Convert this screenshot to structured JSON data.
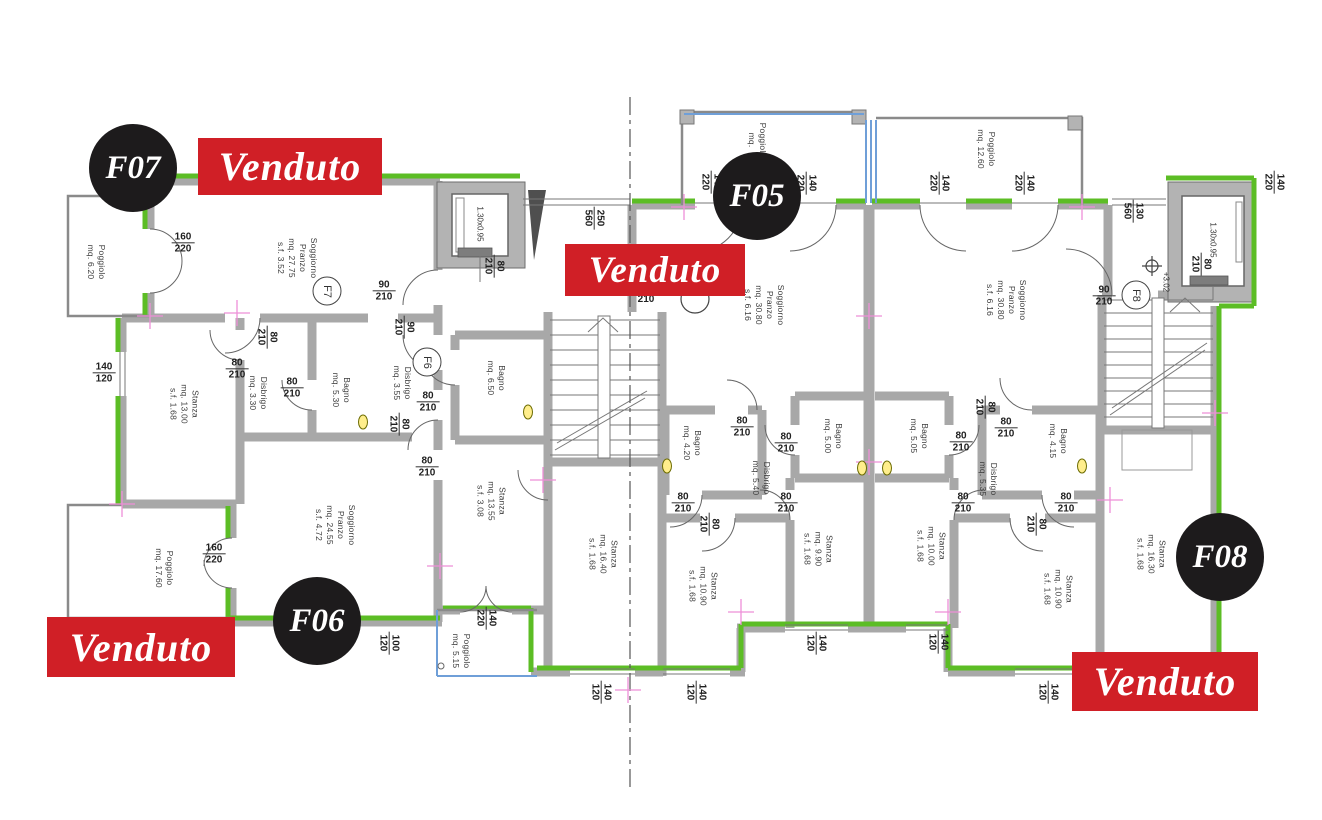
{
  "plan": {
    "status_label": "Venduto",
    "colors": {
      "sold_red": "#d01f26",
      "badge_black": "#1d1b1c",
      "wall_green": "#5cbd25",
      "glass_blue": "#6f9fd8",
      "marker_pink": "#ee8fd8"
    },
    "elevator_label": "1.30x0.95",
    "elevation_label": "+3.02"
  },
  "badges": {
    "f07": "F07",
    "f05": "F05",
    "f06": "F06",
    "f08": "F08"
  },
  "unit_tags": {
    "f7": "F7",
    "f6": "F6",
    "f8": "F8"
  },
  "rooms": [
    {
      "lines": [
        "Poggiolo",
        "mq. 6.20"
      ]
    },
    {
      "lines": [
        "Soggiorno",
        "Pranzo",
        "mq. 27.75",
        "s.f. 3.52"
      ]
    },
    {
      "lines": [
        "Stanza",
        "mq. 13.00",
        "s.f. 1.68"
      ]
    },
    {
      "lines": [
        "Disbrigo",
        "mq. 3.30"
      ]
    },
    {
      "lines": [
        "Bagno",
        "mq. 5.30"
      ]
    },
    {
      "lines": [
        "Disbrigo",
        "mq. 3.55"
      ]
    },
    {
      "lines": [
        "Bagno",
        "mq. 6.50"
      ]
    },
    {
      "lines": [
        "Soggiorno",
        "Pranzo",
        "mq. 24.55",
        "s.f. 4.72"
      ]
    },
    {
      "lines": [
        "Stanza",
        "mq. 13.55",
        "s.f. 3.08"
      ]
    },
    {
      "lines": [
        "Poggiolo",
        "mq. 17.60"
      ]
    },
    {
      "lines": [
        "Poggiolo",
        "mq. 5.15"
      ]
    },
    {
      "lines": [
        "Poggiolo",
        "mq."
      ]
    },
    {
      "lines": [
        "Poggiolo",
        "mq. 12.60"
      ]
    },
    {
      "lines": [
        "Soggiorno",
        "Pranzo",
        "mq. 30.80",
        "s.f. 6.16"
      ]
    },
    {
      "lines": [
        "Bagno",
        "mq. 4.20"
      ]
    },
    {
      "lines": [
        "Disbrigo",
        "mq. 5.40"
      ]
    },
    {
      "lines": [
        "Bagno",
        "mq. 5.00"
      ]
    },
    {
      "lines": [
        "Stanza",
        "mq. 16.40",
        "s.f. 1.68"
      ]
    },
    {
      "lines": [
        "Stanza",
        "mq. 9.90",
        "s.f. 1.68"
      ]
    },
    {
      "lines": [
        "Stanza",
        "mq. 10.90",
        "s.f. 1.68"
      ]
    },
    {
      "lines": [
        "Soggiorno",
        "Pranzo",
        "mq. 30.80",
        "s.f. 6.16"
      ]
    },
    {
      "lines": [
        "Bagno",
        "mq. 5.05"
      ]
    },
    {
      "lines": [
        "Disbrigo",
        "mq. 5.35"
      ]
    },
    {
      "lines": [
        "Bagno",
        "mq. 4.15"
      ]
    },
    {
      "lines": [
        "Stanza",
        "mq. 10.00",
        "s.f. 1.68"
      ]
    },
    {
      "lines": [
        "Stanza",
        "mq. 10.90",
        "s.f. 1.68"
      ]
    },
    {
      "lines": [
        "Stanza",
        "mq. 16.30",
        "s.f. 1.68"
      ]
    }
  ],
  "dims": [
    {
      "a": "160",
      "b": "220"
    },
    {
      "a": "90",
      "b": "210"
    },
    {
      "a": "80",
      "b": "210"
    },
    {
      "a": "80",
      "b": "210"
    },
    {
      "a": "80",
      "b": "210"
    },
    {
      "a": "140",
      "b": "120"
    },
    {
      "a": "90",
      "b": "210"
    },
    {
      "a": "80",
      "b": "210"
    },
    {
      "a": "80",
      "b": "210"
    },
    {
      "a": "80",
      "b": "210"
    },
    {
      "a": "80",
      "b": "210"
    },
    {
      "a": "250",
      "b": "560"
    },
    {
      "a": "160",
      "b": "220"
    },
    {
      "a": "140",
      "b": "220"
    },
    {
      "a": "100",
      "b": "120"
    },
    {
      "a": "140",
      "b": "120"
    },
    {
      "a": "140",
      "b": "120"
    },
    {
      "a": "140",
      "b": "120"
    },
    {
      "a": "140",
      "b": "120"
    },
    {
      "a": "140",
      "b": "120"
    },
    {
      "a": "140",
      "b": "220"
    },
    {
      "a": "140",
      "b": "220"
    },
    {
      "a": "140",
      "b": "220"
    },
    {
      "a": "140",
      "b": "220"
    },
    {
      "a": "140",
      "b": "220"
    },
    {
      "a": "130",
      "b": "560"
    },
    {
      "a": "80",
      "b": "210"
    },
    {
      "a": "90",
      "b": "210"
    },
    {
      "a": "80",
      "b": "210"
    },
    {
      "a": "80",
      "b": "210"
    },
    {
      "a": "80",
      "b": "210"
    },
    {
      "a": "80",
      "b": "210"
    },
    {
      "a": "80",
      "b": "210"
    },
    {
      "a": "80",
      "b": "210"
    },
    {
      "a": "80",
      "b": "210"
    },
    {
      "a": "80",
      "b": "210"
    },
    {
      "a": "80",
      "b": "210"
    },
    {
      "a": "80",
      "b": "210"
    },
    {
      "a": "80",
      "b": "210"
    },
    {
      "a": "",
      "b": "210"
    }
  ]
}
